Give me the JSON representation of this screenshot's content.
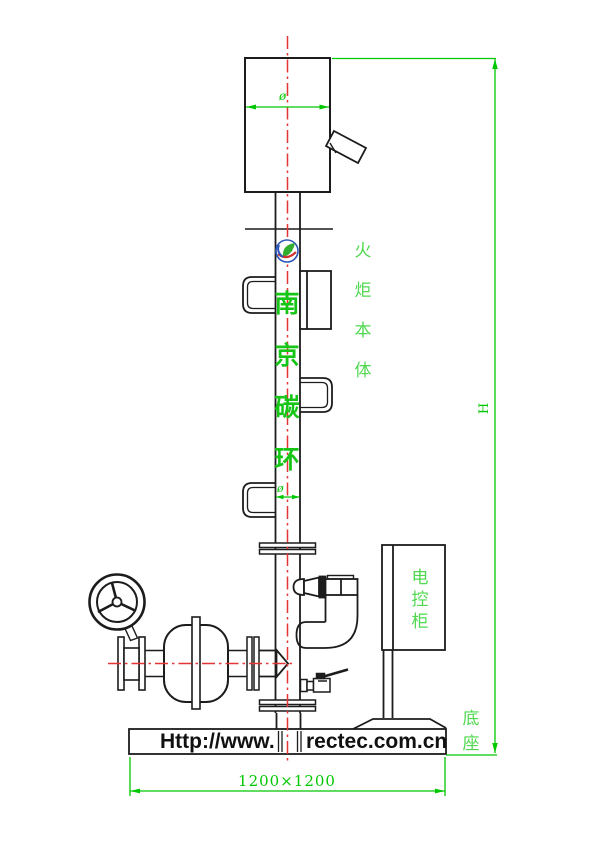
{
  "watermark": {
    "chars": [
      "南",
      "京",
      "碳",
      "环"
    ]
  },
  "labels": {
    "flare_body_chars": [
      "火",
      "炬",
      "本",
      "体"
    ],
    "cabinet_chars": [
      "电",
      "控",
      "柜"
    ],
    "base_chars": [
      "底",
      "座"
    ],
    "height": "H",
    "dia_top": "ø",
    "dia_mid": "ø",
    "base_dimension": "1200×1200",
    "url_prefix": "Http://www.",
    "url_suffix": "rectec.com.cn"
  },
  "colors": {
    "line": "#1c1c1c",
    "centerline_red": "#e63333",
    "dimension_green": "#00c800",
    "label_green": "#4fd84f",
    "watermark_green": "#16c516"
  }
}
